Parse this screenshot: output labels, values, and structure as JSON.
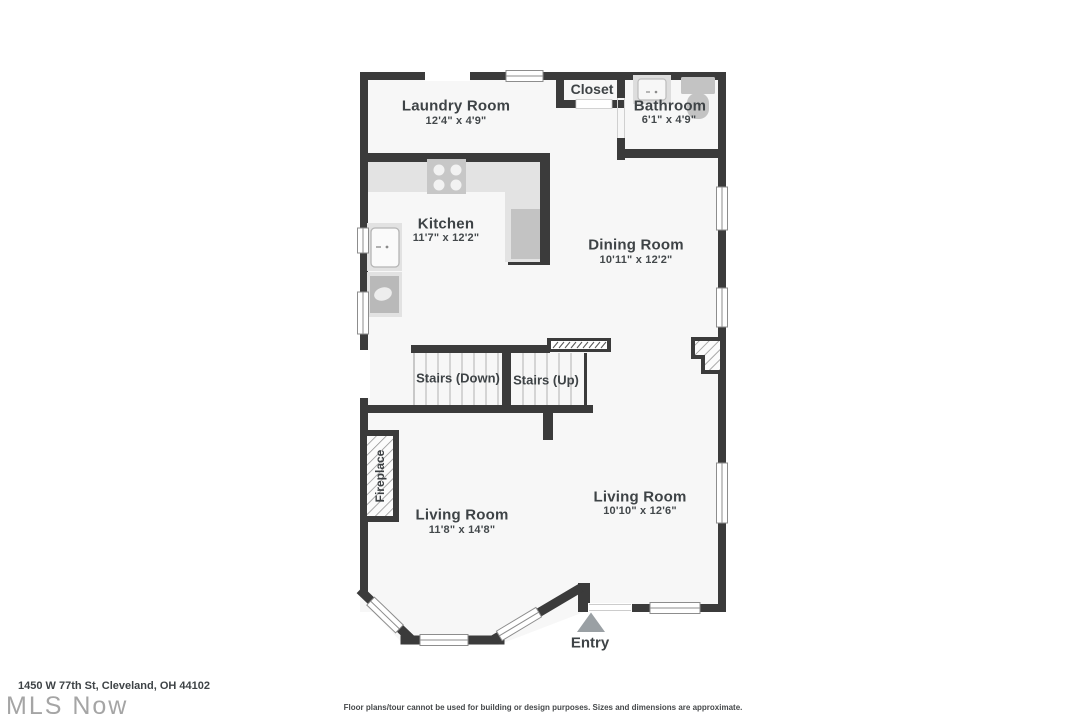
{
  "address": "1450 W 77th St, Cleveland, OH 44102",
  "watermark": "MLS Now",
  "disclaimer": "Floor plans/tour cannot be used for building or design purposes. Sizes and dimensions are approximate.",
  "colors": {
    "wall": "#3b3b3b",
    "floor": "#f7f7f7",
    "label_text": "#3e4346",
    "fixture_light": "#e3e3e3",
    "fixture_mid": "#c4c4c4",
    "entry_arrow": "#9aa0a4",
    "watermark": "#a5a5a5"
  },
  "rooms": {
    "laundry": {
      "name": "Laundry Room",
      "dims": "12'4\" x 4'9\""
    },
    "closet": {
      "name": "Closet"
    },
    "bathroom": {
      "name": "Bathroom",
      "dims": "6'1\" x 4'9\""
    },
    "kitchen": {
      "name": "Kitchen",
      "dims": "11'7\" x 12'2\""
    },
    "dining": {
      "name": "Dining Room",
      "dims": "10'11\" x 12'2\""
    },
    "stairs_down": {
      "name": "Stairs (Down)"
    },
    "stairs_up": {
      "name": "Stairs (Up)"
    },
    "living_left": {
      "name": "Living Room",
      "dims": "11'8\" x 14'8\""
    },
    "living_right": {
      "name": "Living Room",
      "dims": "10'10\" x 12'6\""
    },
    "fireplace": {
      "name": "Fireplace"
    },
    "entry": {
      "name": "Entry"
    }
  },
  "fixtures": [
    "stove",
    "refrigerator",
    "kitchen-sink",
    "dishwasher",
    "bathroom-sink",
    "toilet",
    "fireplace",
    "chimney",
    "entry-arrow"
  ]
}
